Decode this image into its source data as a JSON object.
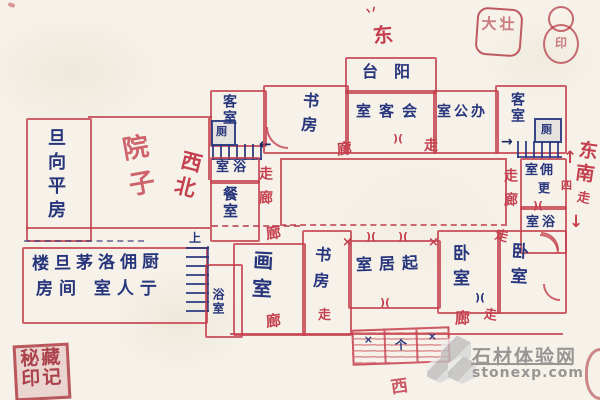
{
  "colors": {
    "ink_red": "#c5404e",
    "ink_blue": "#27357c",
    "seal_red": "#b0303c",
    "watermark_gray": "#8a8a8a",
    "paper": "#f6f2e9"
  },
  "compass": {
    "tick": "丷",
    "east": "东",
    "west": "西",
    "northwest": "西北",
    "southeast": "东南",
    "se_walk": "走",
    "se_block": "四"
  },
  "arrows": {
    "left": "←",
    "right": "→",
    "up": "↑",
    "down": "↓"
  },
  "corridor": {
    "lang": "廊",
    "zou": "走",
    "zoulang": "走廊"
  },
  "rooms": {
    "flat_west": "旦向平房",
    "courtyard": "院子",
    "guest_a": "客室",
    "guest_b": "客室",
    "toilet": "厕",
    "bath_rtl": "室浴",
    "dining": "餐室",
    "study": "书房",
    "balcony": "台阳",
    "meeting_rtl": "室客会",
    "office_rtl": "室公办",
    "maid_rtl": "室佣",
    "maid_sub": "更",
    "service_line1": "楼旦茅洛佣厨",
    "service_line2": "房间 室人亍",
    "stairs_up": "上",
    "bath_v": "浴室",
    "atelier": "画室",
    "living_rtl": "室居起",
    "bedroom": "卧室"
  },
  "marks": {
    "door": ")(",
    "cross": "×",
    "planter_a": "×",
    "planter_b": "个"
  },
  "seals": {
    "square": "大壮",
    "gourd": "印",
    "bottom": "秘藏印记"
  },
  "watermark": {
    "name": "石材体验网",
    "url": "stonexp.com"
  }
}
